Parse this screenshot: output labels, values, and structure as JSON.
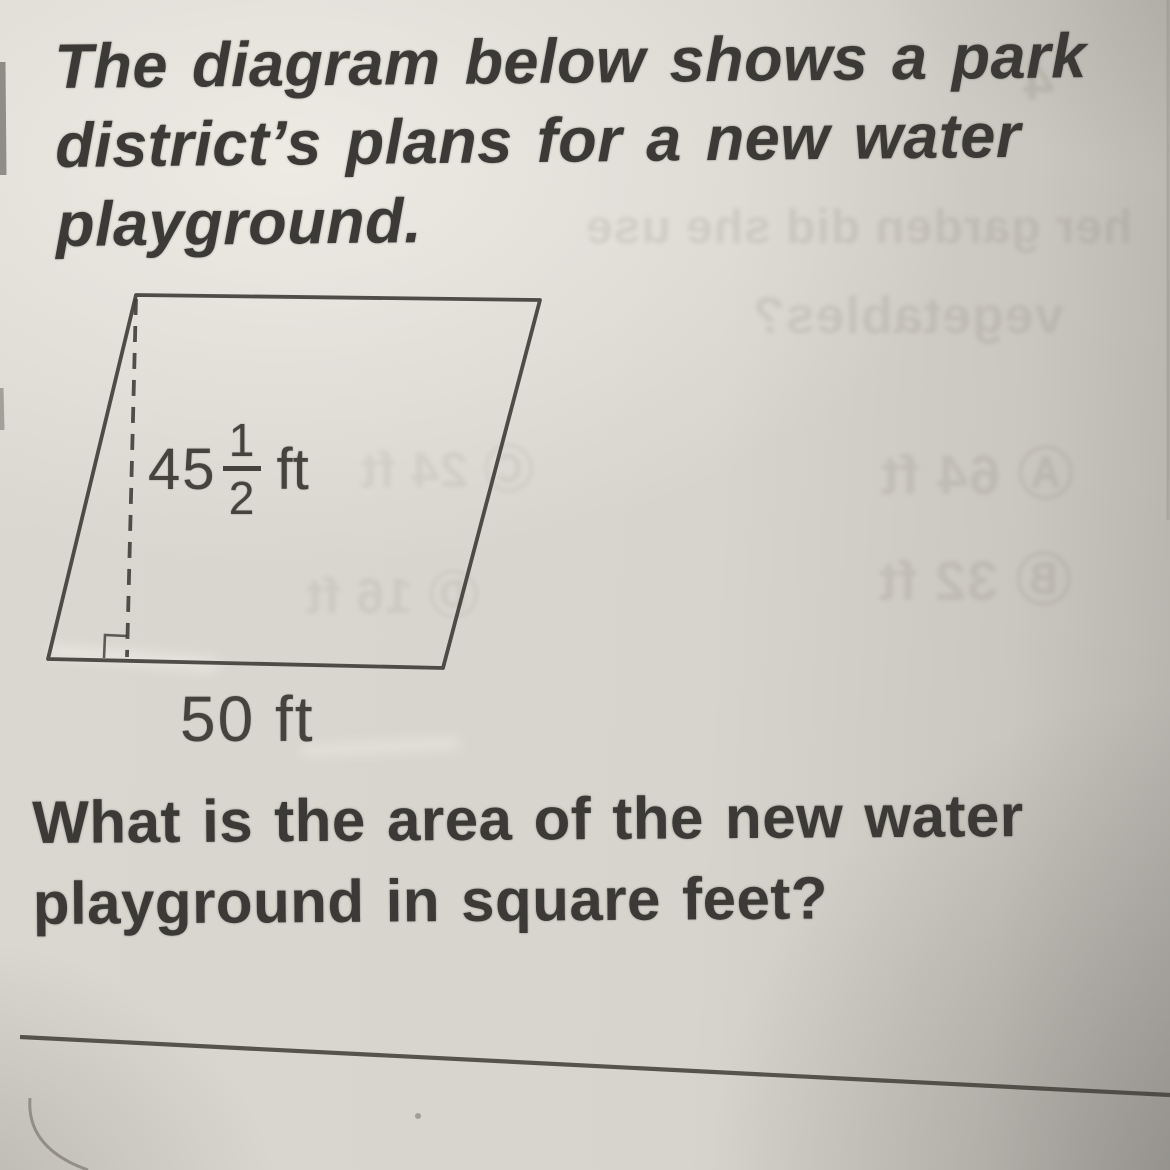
{
  "paper": {
    "base_color": "#d7d4cd",
    "ink_color": "#3c3a36",
    "line_color": "#413f3a"
  },
  "intro": {
    "lines": [
      "The diagram below shows a park",
      "district’s plans for a new water",
      "playground."
    ]
  },
  "diagram": {
    "shape": "parallelogram",
    "height_label": {
      "whole": "45",
      "numerator": "1",
      "denominator": "2",
      "unit": "ft"
    },
    "base_label": "50 ft"
  },
  "question": {
    "lines": [
      "What is the area of the new water",
      "playground in square feet?"
    ]
  },
  "ghost_texts": {
    "items": [
      {
        "text": "her garden did she use"
      },
      {
        "text": "vegetables?"
      },
      {
        "text": "Ⓐ 64 ft"
      },
      {
        "text": "Ⓑ 32 ft"
      },
      {
        "text": "Ⓒ 24 ft"
      },
      {
        "text": "Ⓓ 16 ft"
      },
      {
        "text": "4"
      }
    ]
  }
}
